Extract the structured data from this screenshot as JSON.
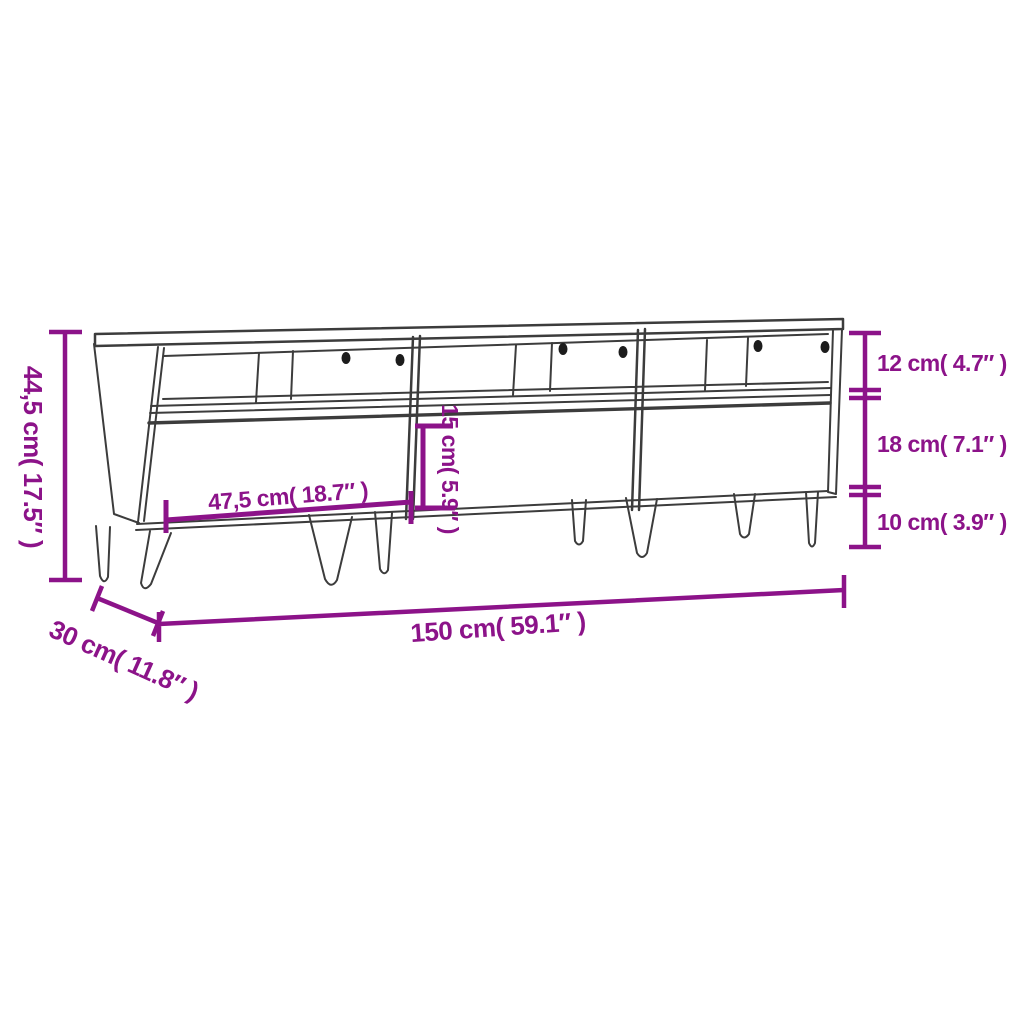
{
  "diagram": {
    "type": "furniture-dimension-diagram",
    "subject": "TV cabinet with three open shelf compartments, three drawers and hairpin legs",
    "colors": {
      "dimension": "#8C1389",
      "drawing": "#3C3C3C",
      "holes": "#1C1C1C",
      "background": "#FFFFFF"
    },
    "labels": {
      "total_height": "44,5 cm( 17.5″ )",
      "opening_height": "12 cm( 4.7″ )",
      "drawer_height": "18 cm( 7.1″ )",
      "leg_height": "10 cm( 3.9″ )",
      "drawer_width": "47,5 cm( 18.7″ )",
      "inner_height": "15 cm( 5.9″ )",
      "total_width": "150 cm( 59.1″ )",
      "total_depth": "30 cm( 11.8″ )"
    }
  }
}
